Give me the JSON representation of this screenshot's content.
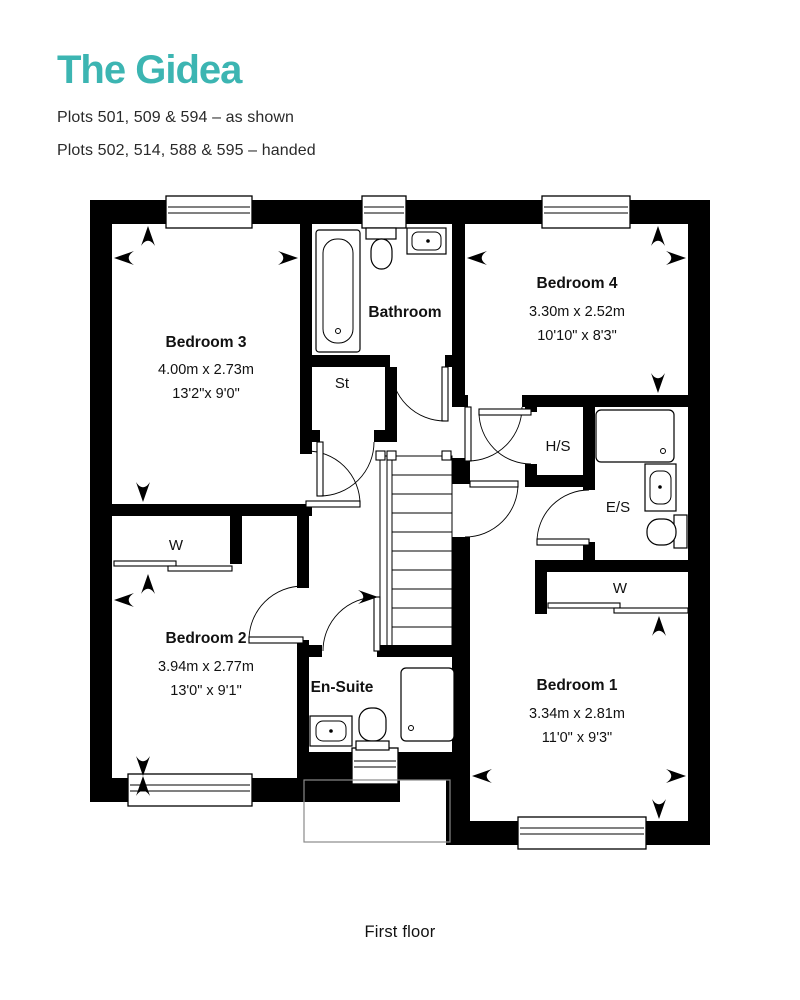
{
  "header": {
    "title": "The Gidea",
    "plots_line1": "Plots 501, 509 & 594 – as shown",
    "plots_line2": "Plots 502, 514, 588 & 595 – handed"
  },
  "rooms": {
    "bedroom3": {
      "name": "Bedroom 3",
      "metric": "4.00m x 2.73m",
      "imperial": "13'2\"x 9'0\""
    },
    "bathroom": {
      "name": "Bathroom"
    },
    "storage": {
      "name": "St"
    },
    "bedroom4": {
      "name": "Bedroom 4",
      "metric": "3.30m x 2.52m",
      "imperial": "10'10\" x 8'3\""
    },
    "hs": {
      "name": "H/S"
    },
    "es": {
      "name": "E/S"
    },
    "wardrobe_bed2": {
      "label": "W"
    },
    "wardrobe_bed1": {
      "label": "W"
    },
    "bedroom2": {
      "name": "Bedroom 2",
      "metric": "3.94m x 2.77m",
      "imperial": "13'0\" x 9'1\""
    },
    "ensuite": {
      "name": "En-Suite"
    },
    "bedroom1": {
      "name": "Bedroom 1",
      "metric": "3.34m x 2.81m",
      "imperial": "11'0\" x 9'3\""
    }
  },
  "footer": {
    "caption": "First floor"
  },
  "colors": {
    "accent_teal": "#3cb5b2",
    "wall_black": "#000000",
    "text_dark": "#1c1c1c",
    "porch_outline": "#8a8a8a"
  },
  "icons": {
    "dimension_arrow": "concave black arrowhead"
  }
}
